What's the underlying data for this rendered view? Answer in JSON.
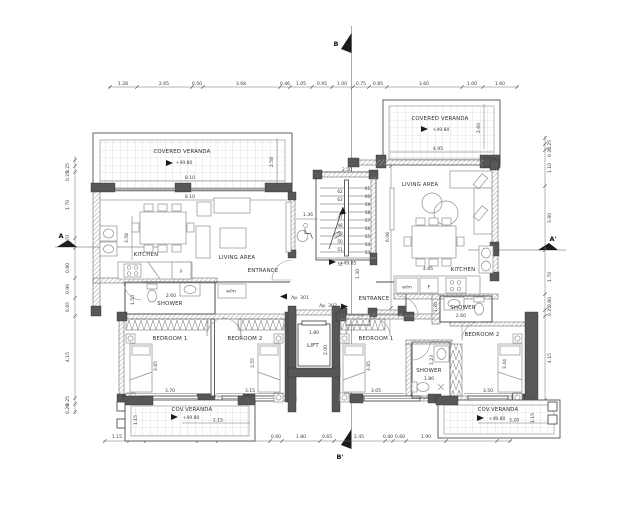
{
  "markers": {
    "top": "B",
    "bottom": "B'",
    "left": "A",
    "right": "A'"
  },
  "dims": {
    "top": [
      "1.28",
      "2.65",
      "0.50",
      "3.68",
      "0.46",
      "1.05",
      "0.95",
      "1.00",
      "0.75",
      "0.85",
      "3.60",
      "1.00",
      "1.60"
    ],
    "bottom": [
      "1.15",
      "0.80",
      "2.45",
      "0.95",
      "2.45",
      "0.60",
      "1.80",
      "0.65",
      "2.45",
      "0.40",
      "0.60",
      "1.90",
      "2.45",
      "0.60"
    ],
    "left": [
      "0.25",
      "0.25",
      "1.70",
      "1.70",
      "0.80",
      "0.90",
      "0.65",
      "4.15",
      "0.25",
      "0.20"
    ],
    "right": [
      "0.25",
      "0.25",
      "1.10",
      "3.90",
      "1.70",
      "0.80",
      "0.25",
      "4.15",
      "0.30",
      "0.25"
    ]
  },
  "core": {
    "stair_width": "2.50",
    "lobby_width": "1.36",
    "landing_level": "+49.85",
    "landing_depth": "1.30",
    "hall_depth": "6.06",
    "entrance": "ENTRANCE",
    "ap_left": "Ap. 301",
    "ap_right": "Ap. 302",
    "lift": {
      "label": "LIFT",
      "width": "1.80",
      "depth": "2.00"
    },
    "stairs_right": [
      "61",
      "60",
      "59",
      "58",
      "57",
      "56",
      "55",
      "54",
      "53"
    ],
    "stairs_left": [
      "62",
      "63",
      "47",
      "48",
      "49",
      "50",
      "51"
    ],
    "stairs_bottom": "52"
  },
  "apt_left": {
    "veranda": {
      "label": "COVERED VERANDA",
      "level": "+49.80",
      "width": "8.10",
      "wall_width": "8.10",
      "depth": "2.58"
    },
    "kitchen": {
      "label": "KITCHEN",
      "depth": "3.58",
      "fridge": "F"
    },
    "living": {
      "label": "LIVING AREA"
    },
    "entrance": "ENTRANCE",
    "wm": "w/m",
    "shower": {
      "label": "SHOWER",
      "width": "2.60",
      "depth": "1.50"
    },
    "bedroom1": {
      "label": "BEDROOM 1",
      "width": "3.70",
      "length": "3.65"
    },
    "bedroom2": {
      "label": "BEDROOM 2",
      "width": "3.15",
      "length": "3.55"
    },
    "cov_veranda": {
      "label": "COV.VERANDA",
      "level": "+49.80",
      "width": "2.15",
      "depth": "1.15"
    }
  },
  "apt_right": {
    "veranda": {
      "label": "COVERED VERANDA",
      "level": "+49.80",
      "width": "4.95",
      "depth": "2.60"
    },
    "living": {
      "label": "LIVING AREA",
      "dining_width": "4.85"
    },
    "kitchen": {
      "label": "KITCHEN",
      "fridge": "F"
    },
    "wm": "w/m",
    "shower_top": {
      "label": "SHOWER",
      "width": "2.60",
      "wall": "1.20"
    },
    "bedroom1": {
      "label": "BEDROOM 1",
      "width": "3.05",
      "length": "3.65"
    },
    "shower_mid": {
      "label": "SHOWER",
      "width": "1.80",
      "depth": "1.23"
    },
    "bedroom2": {
      "label": "BEDROOM 2",
      "width": "3.50",
      "length": "3.44"
    },
    "cov_veranda": {
      "label": "COV.VERANDA",
      "level": "+49.80",
      "width": "3.20",
      "depth": "1.15"
    }
  }
}
